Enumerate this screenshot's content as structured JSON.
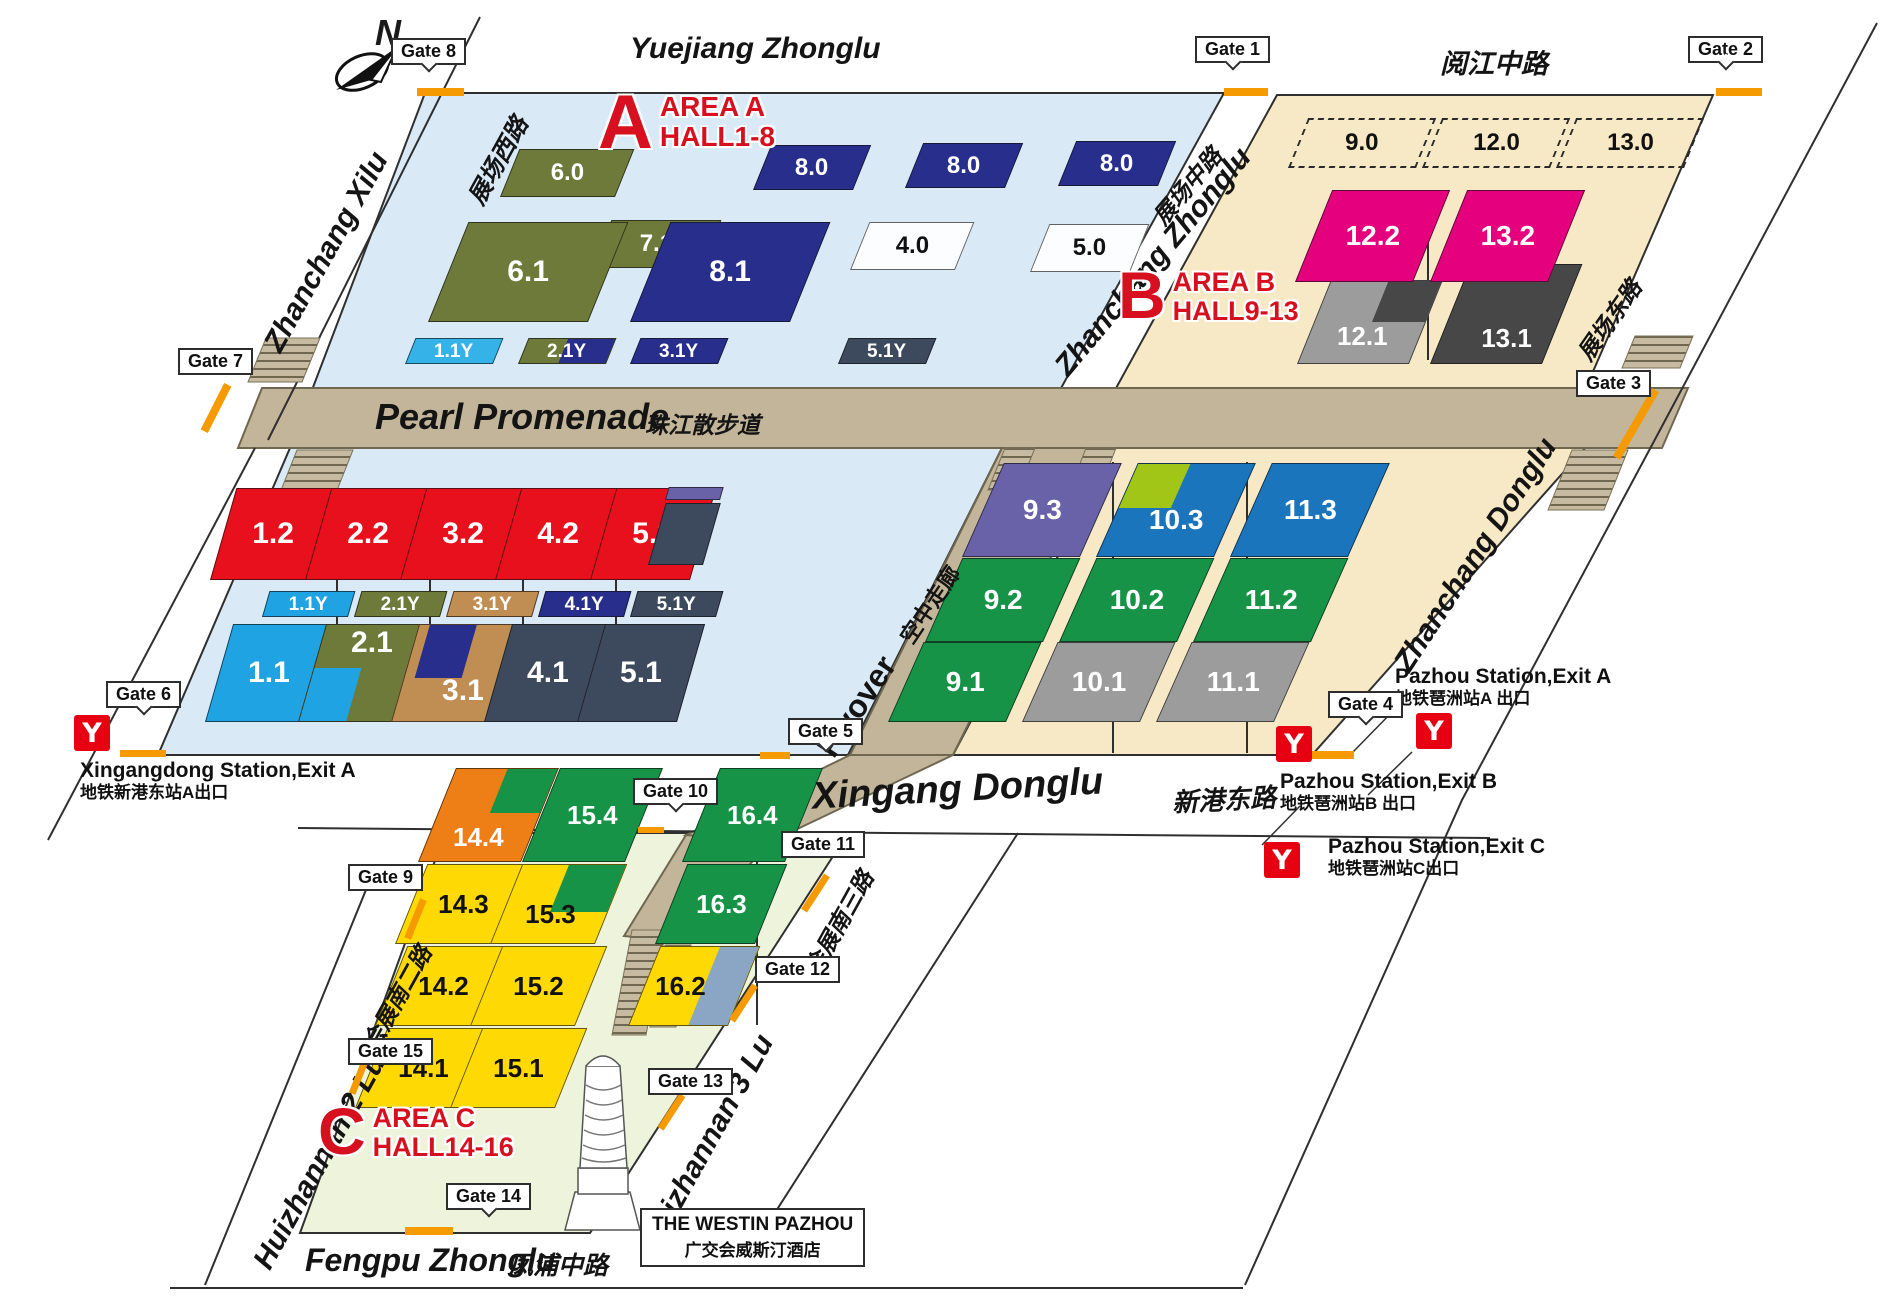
{
  "colors": {
    "red": "#e8101d",
    "navy": "#272e8c",
    "olive": "#6d7a3a",
    "cyan": "#1fa3e2",
    "cyanLight": "#35b3e8",
    "tanbrown": "#c08e52",
    "slate": "#3d4a5e",
    "pink": "#e5017e",
    "gray": "#9c9c9c",
    "darkGray": "#474747",
    "purple": "#6a62a8",
    "blue": "#1b75bc",
    "lime": "#a2c617",
    "green": "#169347",
    "orange": "#ee7f17",
    "yellow": "#ffd903",
    "blueGray": "#8aa6c4",
    "hallWhite": "#fbfdfe",
    "gateOrange": "#f59a00",
    "metroRed": "#e60012",
    "accentRed": "#d7101f",
    "areaA_bg": "#d9eaf6",
    "areaB_bg": "#f8e9c6",
    "areaC_bg": "#eef3dc",
    "promenade": "#c2b59a"
  },
  "icons": {
    "metro_glyph": "Y"
  },
  "compass": {
    "north": "N"
  },
  "areas": {
    "a": {
      "letter": "A",
      "line1": "AREA A",
      "line2": "HALL1-8"
    },
    "b": {
      "letter": "B",
      "line1": "AREA B",
      "line2": "HALL9-13"
    },
    "c": {
      "letter": "C",
      "line1": "AREA C",
      "line2": "HALL14-16"
    }
  },
  "streets": {
    "yuejiang": {
      "en": "Yuejiang Zhonglu",
      "cn": "阅江中路"
    },
    "zhanchang_xilu": {
      "en": "Zhanchang Xilu",
      "cn": "展场西路"
    },
    "zhanchang_zhonglu": {
      "en": "Zhanchang Zhonglu",
      "cn": "展场中路"
    },
    "zhanchang_donglu": {
      "en": "Zhanchang Donglu",
      "cn": "展场东路"
    },
    "xingang": {
      "en": "Xingang Donglu",
      "cn": "新港东路"
    },
    "huizhannan2": {
      "en": "Huizhannan 2 Lu",
      "cn": "会展南二路"
    },
    "huizhannan3": {
      "en": "Huizhannan 3 Lu",
      "cn": "会展南三路"
    },
    "fengpu": {
      "en": "Fengpu Zhonglu",
      "cn": "凤浦中路"
    }
  },
  "landmarks": {
    "promenade": {
      "en": "Pearl Promenade",
      "cn": "珠江散步道"
    },
    "flyover": {
      "en": "Flyover",
      "cn": "空中走廊"
    },
    "westin": {
      "en": "THE WESTIN PAZHOU",
      "cn": "广交会威斯汀酒店"
    }
  },
  "stations": {
    "xingangdong": {
      "en": "Xingangdong Station,Exit A",
      "cn": "地铁新港东站A出口"
    },
    "pazhouA": {
      "en": "Pazhou Station,Exit A",
      "cn": "地铁琶洲站A 出口"
    },
    "pazhouB": {
      "en": "Pazhou Station,Exit B",
      "cn": "地铁琶洲站B 出口"
    },
    "pazhouC": {
      "en": "Pazhou Station,Exit C",
      "cn": "地铁琶洲站C出口"
    }
  },
  "gates": [
    {
      "id": "gate-1",
      "label": "Gate 1"
    },
    {
      "id": "gate-2",
      "label": "Gate 2"
    },
    {
      "id": "gate-3",
      "label": "Gate 3"
    },
    {
      "id": "gate-4",
      "label": "Gate 4"
    },
    {
      "id": "gate-5",
      "label": "Gate 5"
    },
    {
      "id": "gate-6",
      "label": "Gate 6"
    },
    {
      "id": "gate-7",
      "label": "Gate 7"
    },
    {
      "id": "gate-8",
      "label": "Gate 8"
    },
    {
      "id": "gate-9",
      "label": "Gate 9"
    },
    {
      "id": "gate-10",
      "label": "Gate 10"
    },
    {
      "id": "gate-11",
      "label": "Gate 11"
    },
    {
      "id": "gate-12",
      "label": "Gate 12"
    },
    {
      "id": "gate-13",
      "label": "Gate 13"
    },
    {
      "id": "gate-14",
      "label": "Gate 14"
    },
    {
      "id": "gate-15",
      "label": "Gate 15"
    }
  ],
  "halls": [
    {
      "id": "6.0",
      "label": "6.0",
      "color": "olive"
    },
    {
      "id": "8.0a",
      "label": "8.0",
      "color": "navy"
    },
    {
      "id": "8.0b",
      "label": "8.0",
      "color": "navy"
    },
    {
      "id": "8.0c",
      "label": "8.0",
      "color": "navy"
    },
    {
      "id": "7.1",
      "label": "7.1",
      "color": "olive"
    },
    {
      "id": "4.0",
      "label": "4.0",
      "color": "hallWhite",
      "text": "#111111"
    },
    {
      "id": "5.0",
      "label": "5.0",
      "color": "hallWhite",
      "text": "#111111"
    },
    {
      "id": "6.1",
      "label": "6.1",
      "color": "olive"
    },
    {
      "id": "8.1",
      "label": "8.1",
      "color": "navy"
    },
    {
      "id": "a1.1Y",
      "label": "1.1Y",
      "color": "cyanLight"
    },
    {
      "id": "a2.1Y",
      "label": "2.1Y",
      "color": "olive"
    },
    {
      "id": "a3.1Y",
      "label": "3.1Y",
      "color": "navy"
    },
    {
      "id": "a5.1Y",
      "label": "5.1Y",
      "color": "slate"
    },
    {
      "id": "9.0",
      "label": "9.0",
      "color": "dashed",
      "text": "#111111"
    },
    {
      "id": "12.0",
      "label": "12.0",
      "color": "dashed",
      "text": "#111111"
    },
    {
      "id": "13.0",
      "label": "13.0",
      "color": "dashed",
      "text": "#111111"
    },
    {
      "id": "12.1",
      "label": "12.1",
      "color": "gray"
    },
    {
      "id": "13.1",
      "label": "13.1",
      "color": "darkGray"
    },
    {
      "id": "12.2",
      "label": "12.2",
      "color": "pink"
    },
    {
      "id": "13.2",
      "label": "13.2",
      "color": "pink"
    },
    {
      "id": "1.2",
      "label": "1.2",
      "color": "red"
    },
    {
      "id": "2.2",
      "label": "2.2",
      "color": "red"
    },
    {
      "id": "3.2",
      "label": "3.2",
      "color": "red"
    },
    {
      "id": "4.2",
      "label": "4.2",
      "color": "red"
    },
    {
      "id": "5.2",
      "label": "5.2",
      "color": "red"
    },
    {
      "id": "m1.1Y",
      "label": "1.1Y",
      "color": "cyan"
    },
    {
      "id": "m2.1Y",
      "label": "2.1Y",
      "color": "olive"
    },
    {
      "id": "m3.1Y",
      "label": "3.1Y",
      "color": "tanbrown"
    },
    {
      "id": "m4.1Y",
      "label": "4.1Y",
      "color": "navy"
    },
    {
      "id": "m5.1Y",
      "label": "5.1Y",
      "color": "slate"
    },
    {
      "id": "1.1",
      "label": "1.1",
      "color": "cyan"
    },
    {
      "id": "2.1",
      "label": "2.1",
      "color": "olive"
    },
    {
      "id": "3.1",
      "label": "3.1",
      "color": "tanbrown"
    },
    {
      "id": "4.1",
      "label": "4.1",
      "color": "slate"
    },
    {
      "id": "5.1",
      "label": "5.1",
      "color": "slate"
    },
    {
      "id": "9.1",
      "label": "9.1",
      "color": "green"
    },
    {
      "id": "10.1",
      "label": "10.1",
      "color": "gray"
    },
    {
      "id": "11.1",
      "label": "11.1",
      "color": "gray"
    },
    {
      "id": "9.2",
      "label": "9.2",
      "color": "green"
    },
    {
      "id": "10.2",
      "label": "10.2",
      "color": "green"
    },
    {
      "id": "11.2",
      "label": "11.2",
      "color": "green"
    },
    {
      "id": "9.3",
      "label": "9.3",
      "color": "purple"
    },
    {
      "id": "10.3",
      "label": "10.3",
      "color": "blue"
    },
    {
      "id": "11.3",
      "label": "11.3",
      "color": "blue"
    },
    {
      "id": "14.1",
      "label": "14.1",
      "color": "yellow",
      "text": "#111111"
    },
    {
      "id": "15.1",
      "label": "15.1",
      "color": "yellow",
      "text": "#111111"
    },
    {
      "id": "14.2",
      "label": "14.2",
      "color": "yellow",
      "text": "#111111"
    },
    {
      "id": "15.2",
      "label": "15.2",
      "color": "yellow",
      "text": "#111111"
    },
    {
      "id": "16.2",
      "label": "16.2",
      "color": "yellow",
      "text": "#111111"
    },
    {
      "id": "14.3",
      "label": "14.3",
      "color": "yellow",
      "text": "#111111"
    },
    {
      "id": "15.3",
      "label": "15.3",
      "color": "yellow",
      "text": "#111111"
    },
    {
      "id": "16.3",
      "label": "16.3",
      "color": "green"
    },
    {
      "id": "14.4",
      "label": "14.4",
      "color": "orange"
    },
    {
      "id": "15.4",
      "label": "15.4",
      "color": "green"
    },
    {
      "id": "16.4",
      "label": "16.4",
      "color": "green"
    }
  ]
}
